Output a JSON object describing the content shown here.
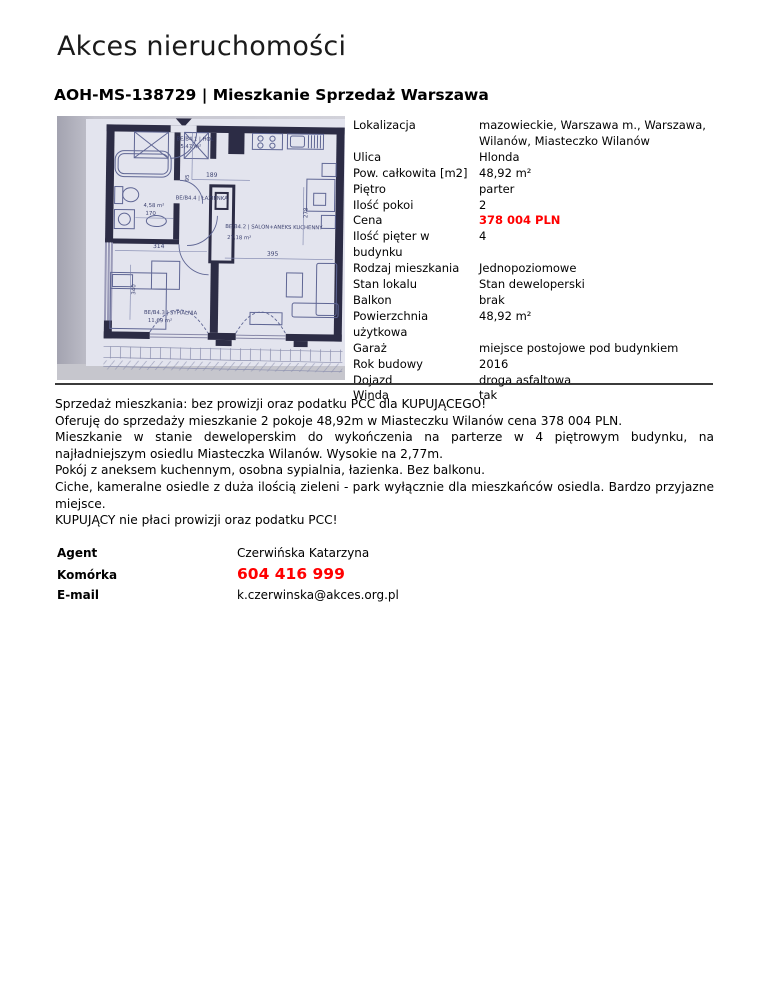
{
  "header": {
    "agency": "Akces nieruchomości",
    "listing_title": "AOH-MS-138729 | Mieszkanie Sprzedaż Warszawa"
  },
  "colors": {
    "accent_red": "#ff0000",
    "text": "#000000",
    "plan_wall": "#2c2c45",
    "plan_line": "#5f6694",
    "plan_paper": "#e3e4ee"
  },
  "floorplan": {
    "rooms": [
      {
        "code": "BE/B4.1 | HOL",
        "area": "5,47 m²"
      },
      {
        "code": "BE/B4.4 | ŁAZIENKA",
        "area": "4,58 m²"
      },
      {
        "code": "BE/B4.2 | SALON+ANEKS KUCHENNY",
        "area": "27,18 m²"
      },
      {
        "code": "BE/B4.3 | SYPIALNIA",
        "area": "11,69 m²"
      }
    ],
    "dimensions": {
      "d189": "189",
      "d95": "95",
      "d170": "170",
      "d314": "314",
      "d395": "395",
      "d340": "340",
      "d278": "278"
    }
  },
  "details": {
    "rows": [
      {
        "label": "Lokalizacja",
        "value": "mazowieckie, Warszawa m., Warszawa, Wilanów, Miasteczko Wilanów"
      },
      {
        "label": "Ulica",
        "value": "Hlonda"
      },
      {
        "label": "Pow. całkowita [m2]",
        "value": "48,92 m²"
      },
      {
        "label": "Piętro",
        "value": "parter"
      },
      {
        "label": "Ilość pokoi",
        "value": "2"
      },
      {
        "label": "Cena",
        "value": "378 004 PLN"
      },
      {
        "label": "Ilość pięter w budynku",
        "value": "4"
      },
      {
        "label": "Rodzaj mieszkania",
        "value": "Jednopoziomowe"
      },
      {
        "label": "Stan lokalu",
        "value": "Stan deweloperski"
      },
      {
        "label": "Balkon",
        "value": "brak"
      },
      {
        "label": "Powierzchnia użytkowa",
        "value": "48,92 m²"
      },
      {
        "label": "Garaż",
        "value": "miejsce postojowe pod budynkiem"
      },
      {
        "label": "Rok budowy",
        "value": "2016"
      },
      {
        "label": "Dojazd",
        "value": "droga asfaltowa"
      },
      {
        "label": "Winda",
        "value": "tak"
      }
    ]
  },
  "description": {
    "paragraphs": [
      "Sprzedaż mieszkania: bez prowizji oraz podatku PCC dla KUPUJĄCEGO!",
      "Oferuję do sprzedaży mieszkanie 2 pokoje 48,92m w Miasteczku Wilanów cena 378 004 PLN.",
      "Mieszkanie w stanie deweloperskim do wykończenia na parterze w 4 piętrowym budynku, na najładniejszym osiedlu Miasteczka Wilanów. Wysokie na 2,77m.",
      "Pokój z aneksem kuchennym, osobna sypialnia, łazienka. Bez balkonu.",
      "Ciche, kameralne osiedle z duża ilością zieleni - park wyłącznie dla mieszkańców osiedla. Bardzo przyjazne miejsce.",
      "KUPUJĄCY nie płaci prowizji oraz podatku PCC!"
    ]
  },
  "agent": {
    "rows": [
      {
        "label": "Agent",
        "value": "Czerwińska Katarzyna"
      },
      {
        "label": "Komórka",
        "value": "604 416 999"
      },
      {
        "label": "E-mail",
        "value": "k.czerwinska@akces.org.pl"
      }
    ]
  }
}
